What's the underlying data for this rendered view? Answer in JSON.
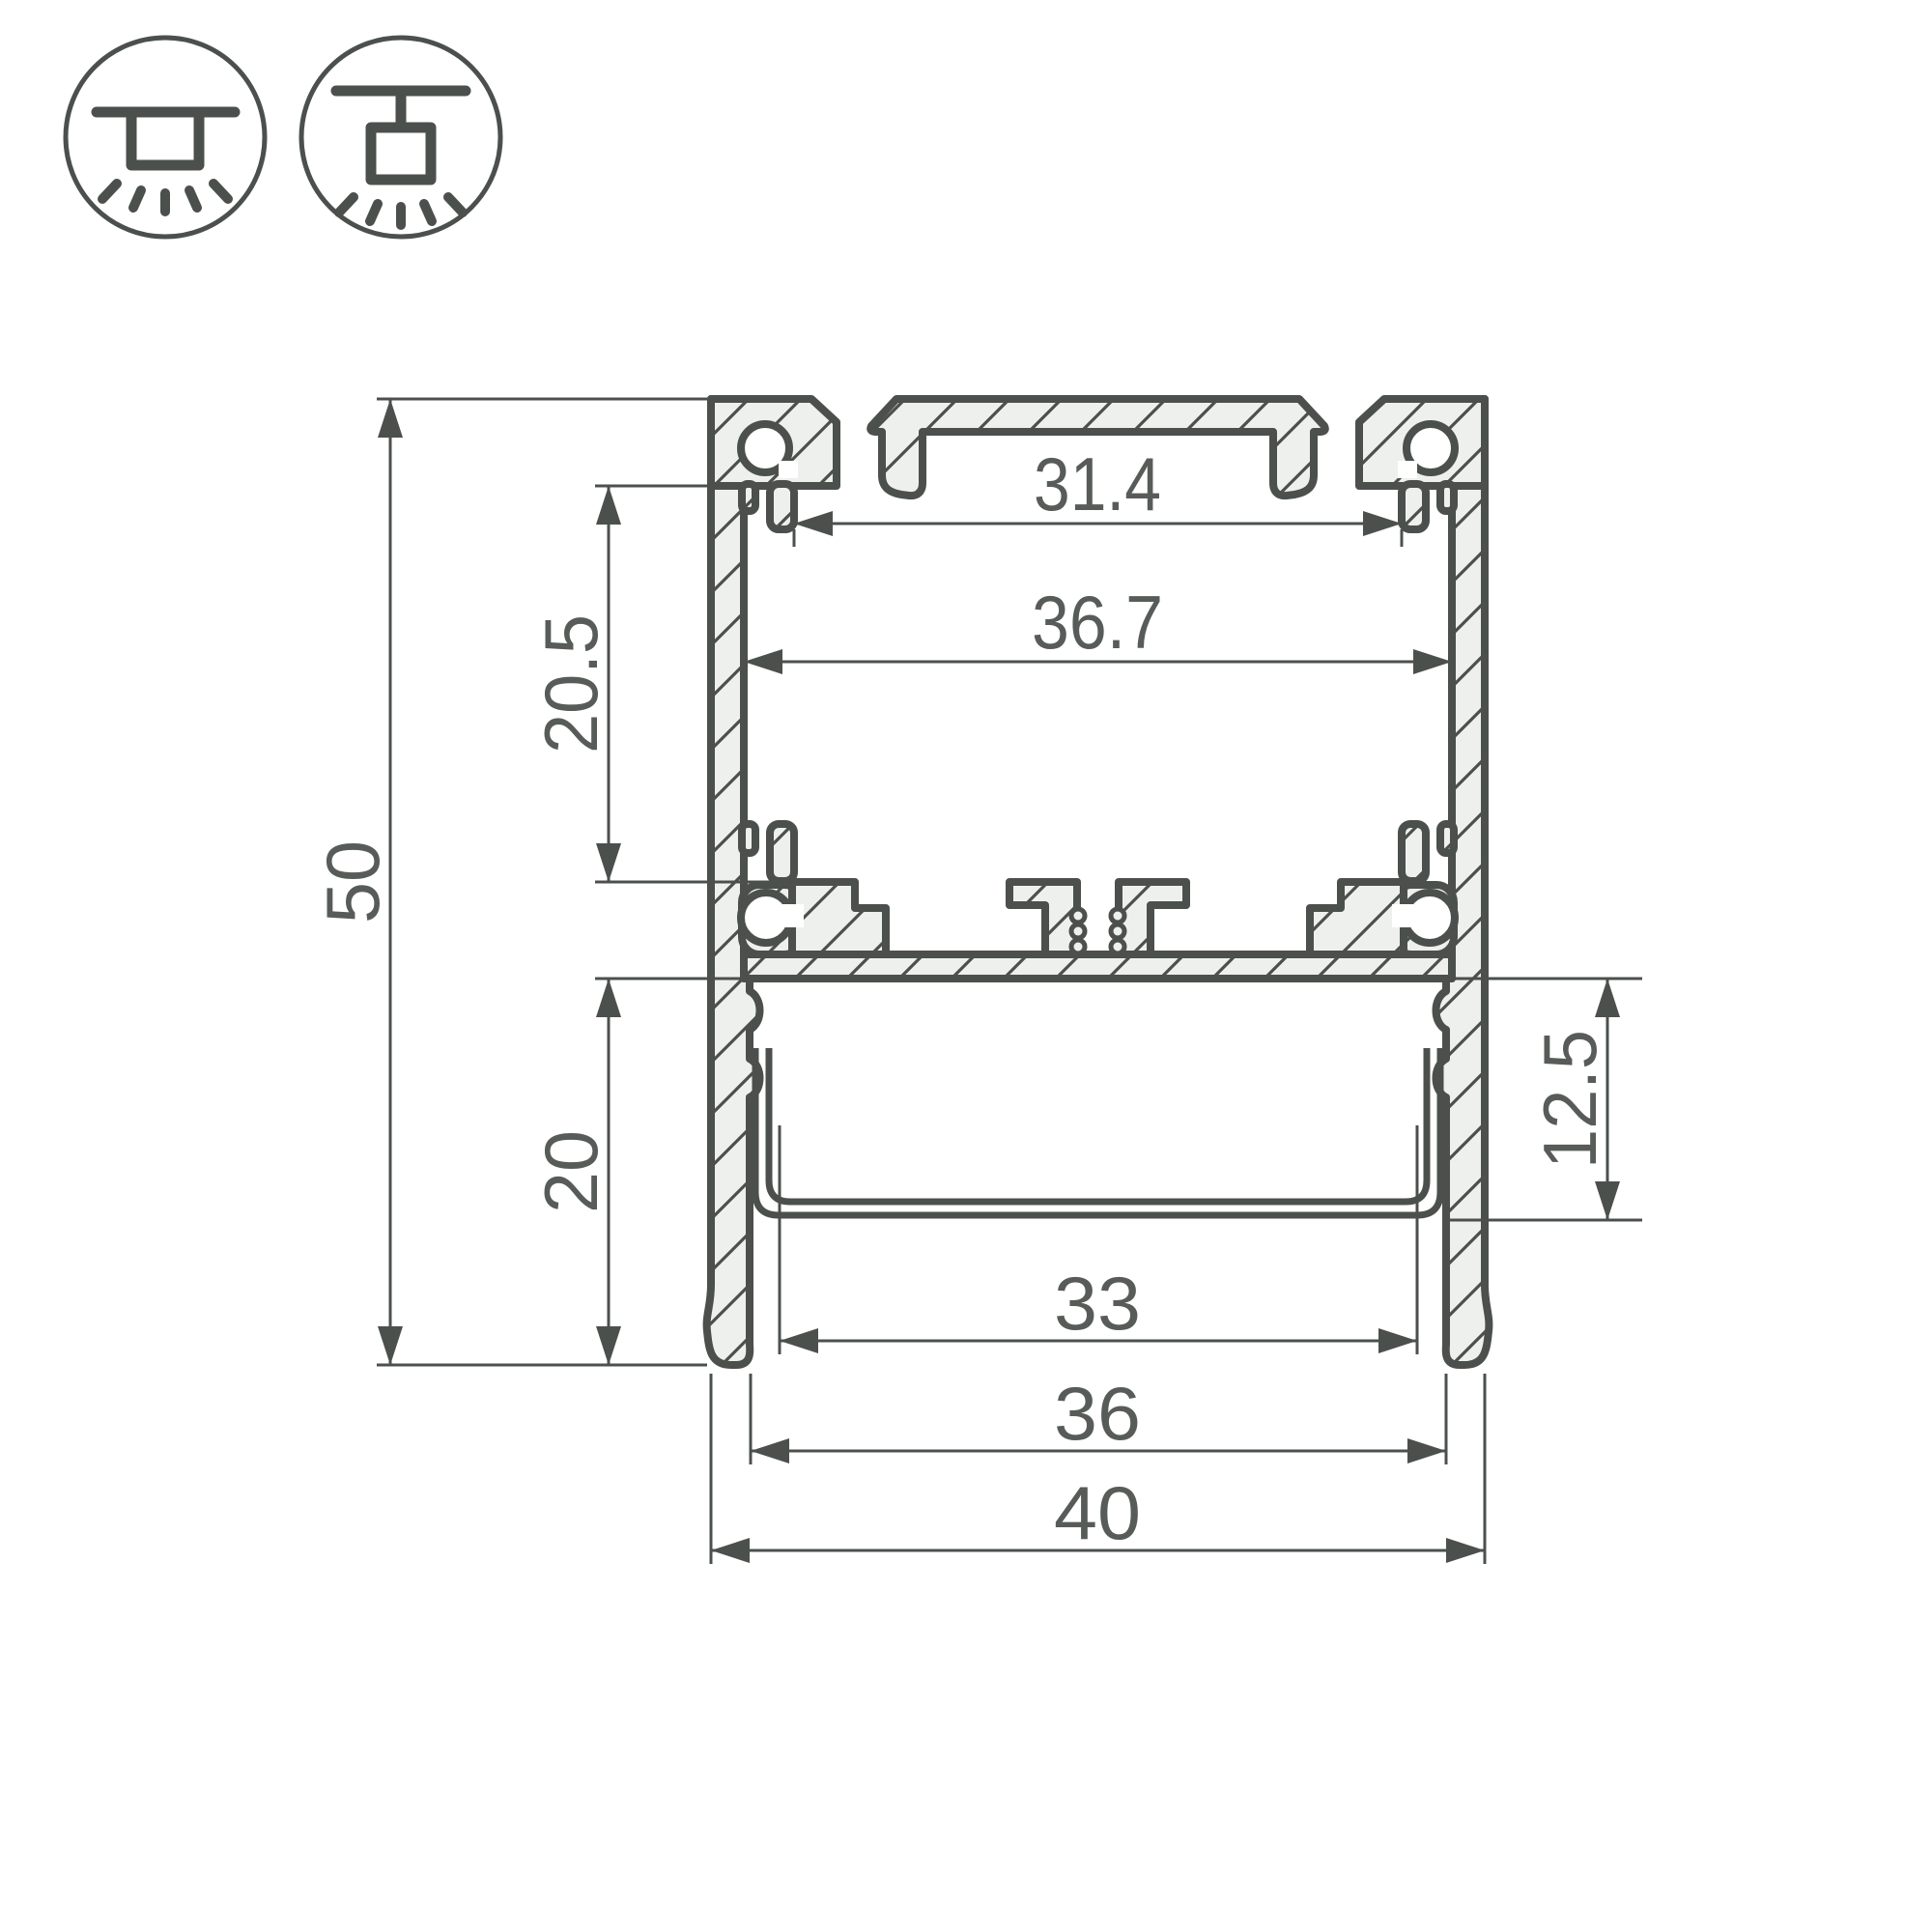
{
  "title": "led-profile-cross-section-drawing",
  "colors": {
    "background": "#ffffff",
    "outline": "#4b504d",
    "metal_fill": "#eef0ee",
    "dimension_line": "#4b504d",
    "text": "#575c59"
  },
  "icons": {
    "surface_mount": "surface-ceiling-mount-luminaire-icon",
    "pendant_mount": "pendant-ceiling-mount-luminaire-icon"
  },
  "drawing": {
    "type": "aluminium-profile-cross-section",
    "units": "mm",
    "labels": {
      "top_slot_width": "31.4",
      "inner_width": "36.7",
      "upper_cavity_height": "20.5",
      "overall_height": "50",
      "lower_cavity_height": "20",
      "diffuser_depth": "12.5",
      "diffuser_width": "33",
      "bottom_inner_width": "36",
      "overall_width": "40"
    }
  }
}
